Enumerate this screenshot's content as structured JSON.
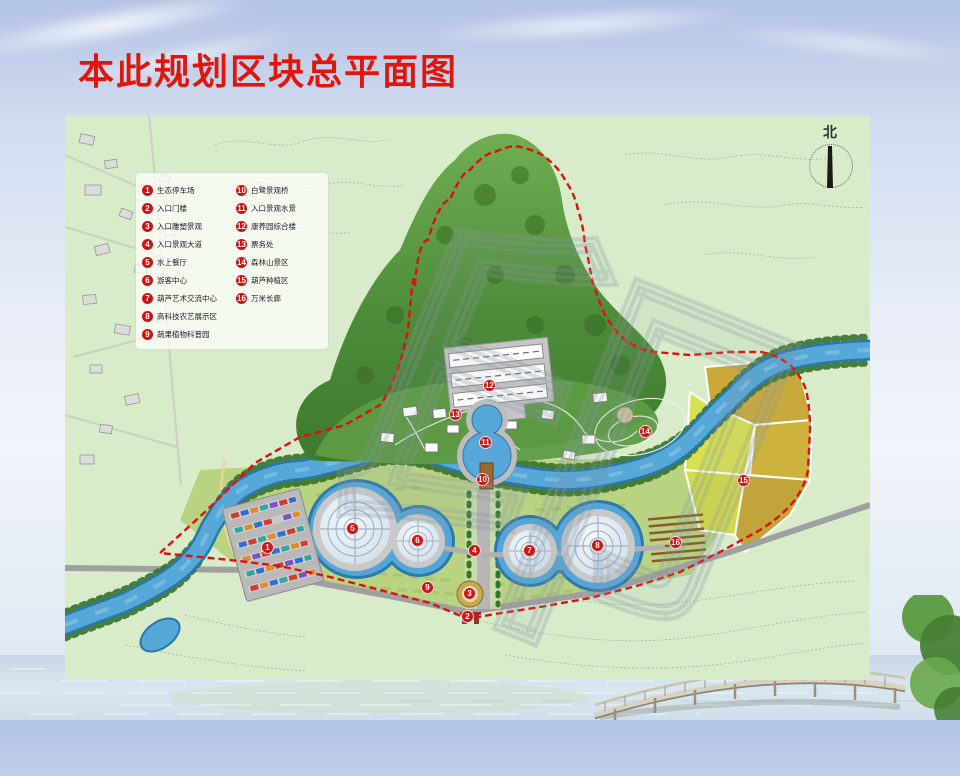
{
  "slide": {
    "title": "本此规划区块总平面图"
  },
  "legend": {
    "items": [
      {
        "num": "1",
        "label": "生态停车场"
      },
      {
        "num": "2",
        "label": "入口门楼"
      },
      {
        "num": "3",
        "label": "入口雕塑景观"
      },
      {
        "num": "4",
        "label": "入口景观大道"
      },
      {
        "num": "5",
        "label": "水上餐厅"
      },
      {
        "num": "6",
        "label": "游客中心"
      },
      {
        "num": "7",
        "label": "葫芦艺术交流中心"
      },
      {
        "num": "8",
        "label": "高科技农艺展示区"
      },
      {
        "num": "9",
        "label": "蔬果植物科普园"
      },
      {
        "num": "10",
        "label": "白鹭景观桥"
      },
      {
        "num": "11",
        "label": "入口景观水景"
      },
      {
        "num": "12",
        "label": "康养园综合楼"
      },
      {
        "num": "13",
        "label": "票务处"
      },
      {
        "num": "14",
        "label": "森林山景区"
      },
      {
        "num": "15",
        "label": "葫芦种植区"
      },
      {
        "num": "16",
        "label": "万米长廊"
      }
    ]
  },
  "map": {
    "north_label": "北",
    "watermark": "印",
    "markers": [
      {
        "num": "1",
        "x": 268,
        "y": 548
      },
      {
        "num": "2",
        "x": 468,
        "y": 617
      },
      {
        "num": "3",
        "x": 470,
        "y": 594
      },
      {
        "num": "4",
        "x": 475,
        "y": 551
      },
      {
        "num": "5",
        "x": 353,
        "y": 529
      },
      {
        "num": "6",
        "x": 418,
        "y": 541
      },
      {
        "num": "7",
        "x": 530,
        "y": 551
      },
      {
        "num": "8",
        "x": 598,
        "y": 546
      },
      {
        "num": "9",
        "x": 428,
        "y": 588
      },
      {
        "num": "10",
        "x": 483,
        "y": 480
      },
      {
        "num": "11",
        "x": 486,
        "y": 443
      },
      {
        "num": "12",
        "x": 490,
        "y": 386
      },
      {
        "num": "13",
        "x": 456,
        "y": 415
      },
      {
        "num": "14",
        "x": 646,
        "y": 432
      },
      {
        "num": "15",
        "x": 744,
        "y": 481
      },
      {
        "num": "16",
        "x": 676,
        "y": 543
      }
    ]
  },
  "colors": {
    "title_red": "#e1150a",
    "marker_red": "#d11414",
    "boundary_red": "#e01010",
    "river_blue": "#55a8d8",
    "hill_green": "#4e8c3a",
    "field_yellow": "#d4d94c"
  }
}
